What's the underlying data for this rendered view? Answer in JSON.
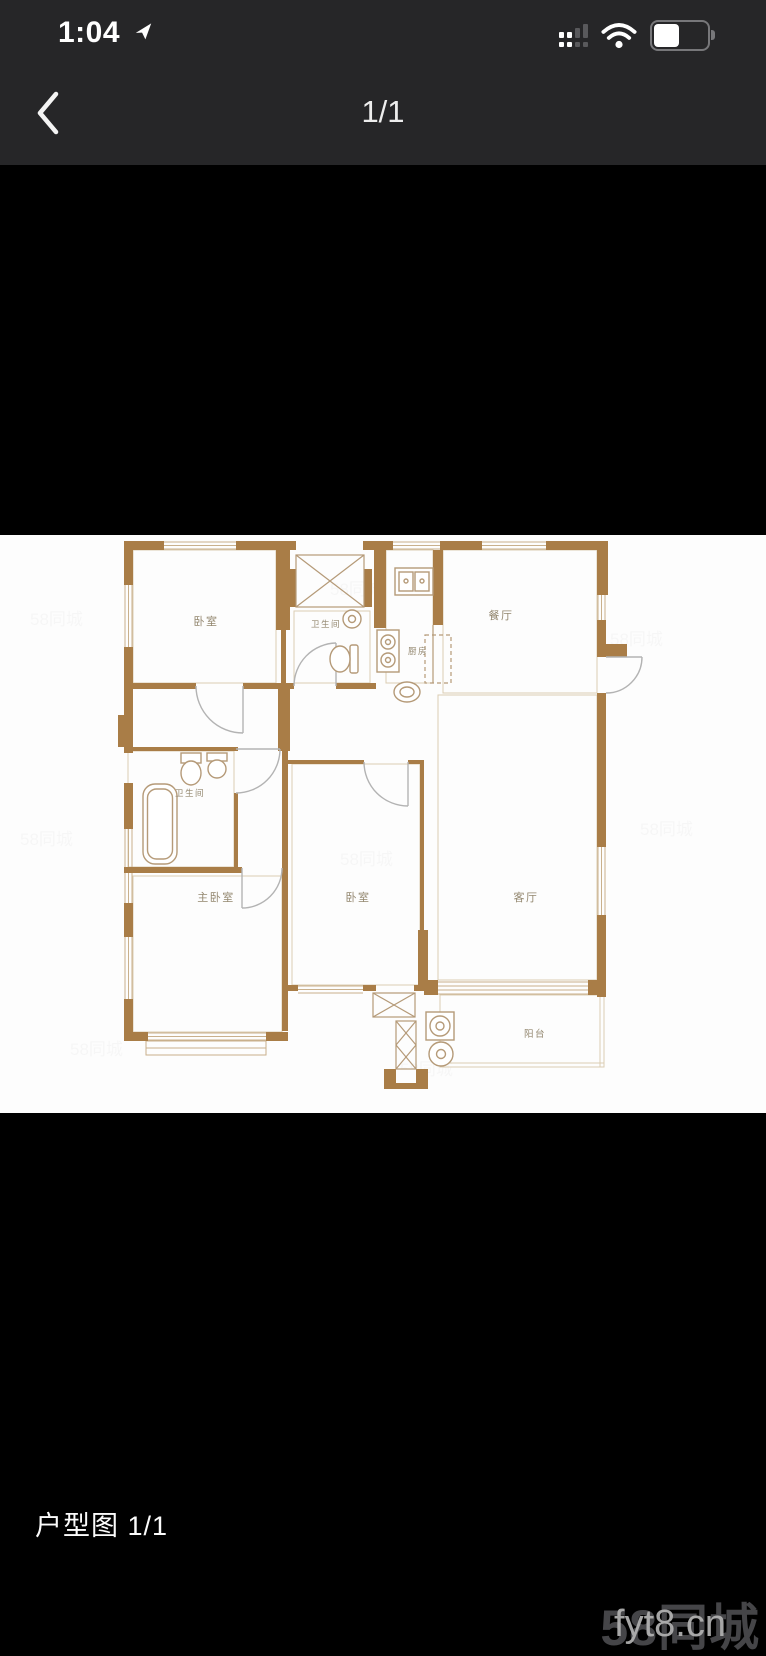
{
  "status_bar": {
    "time": "1:04"
  },
  "nav_bar": {
    "page_indicator": "1/1"
  },
  "caption": "户型图 1/1",
  "watermarks": {
    "site": "58同城",
    "overlay": "fyt8.cn",
    "tile": "58同城"
  },
  "floor_plan": {
    "rooms": [
      {
        "id": "bedroom-top",
        "label": "卧室"
      },
      {
        "id": "bathroom-top",
        "label": "卫生间"
      },
      {
        "id": "kitchen",
        "label": "厨房"
      },
      {
        "id": "dining-room",
        "label": "餐厅"
      },
      {
        "id": "bathroom-left",
        "label": "卫生间"
      },
      {
        "id": "master-bedroom",
        "label": "主卧室"
      },
      {
        "id": "bedroom-middle",
        "label": "卧室"
      },
      {
        "id": "living-room",
        "label": "客厅"
      },
      {
        "id": "balcony",
        "label": "阳台"
      }
    ],
    "colors": {
      "wall": "#a97d47",
      "window_line": "#c9b08c",
      "outline": "#dccdb2",
      "fixture": "#b59a78",
      "door_arc": "#b3b3b3",
      "label": "#93876f",
      "header_bg": "#262628"
    }
  }
}
